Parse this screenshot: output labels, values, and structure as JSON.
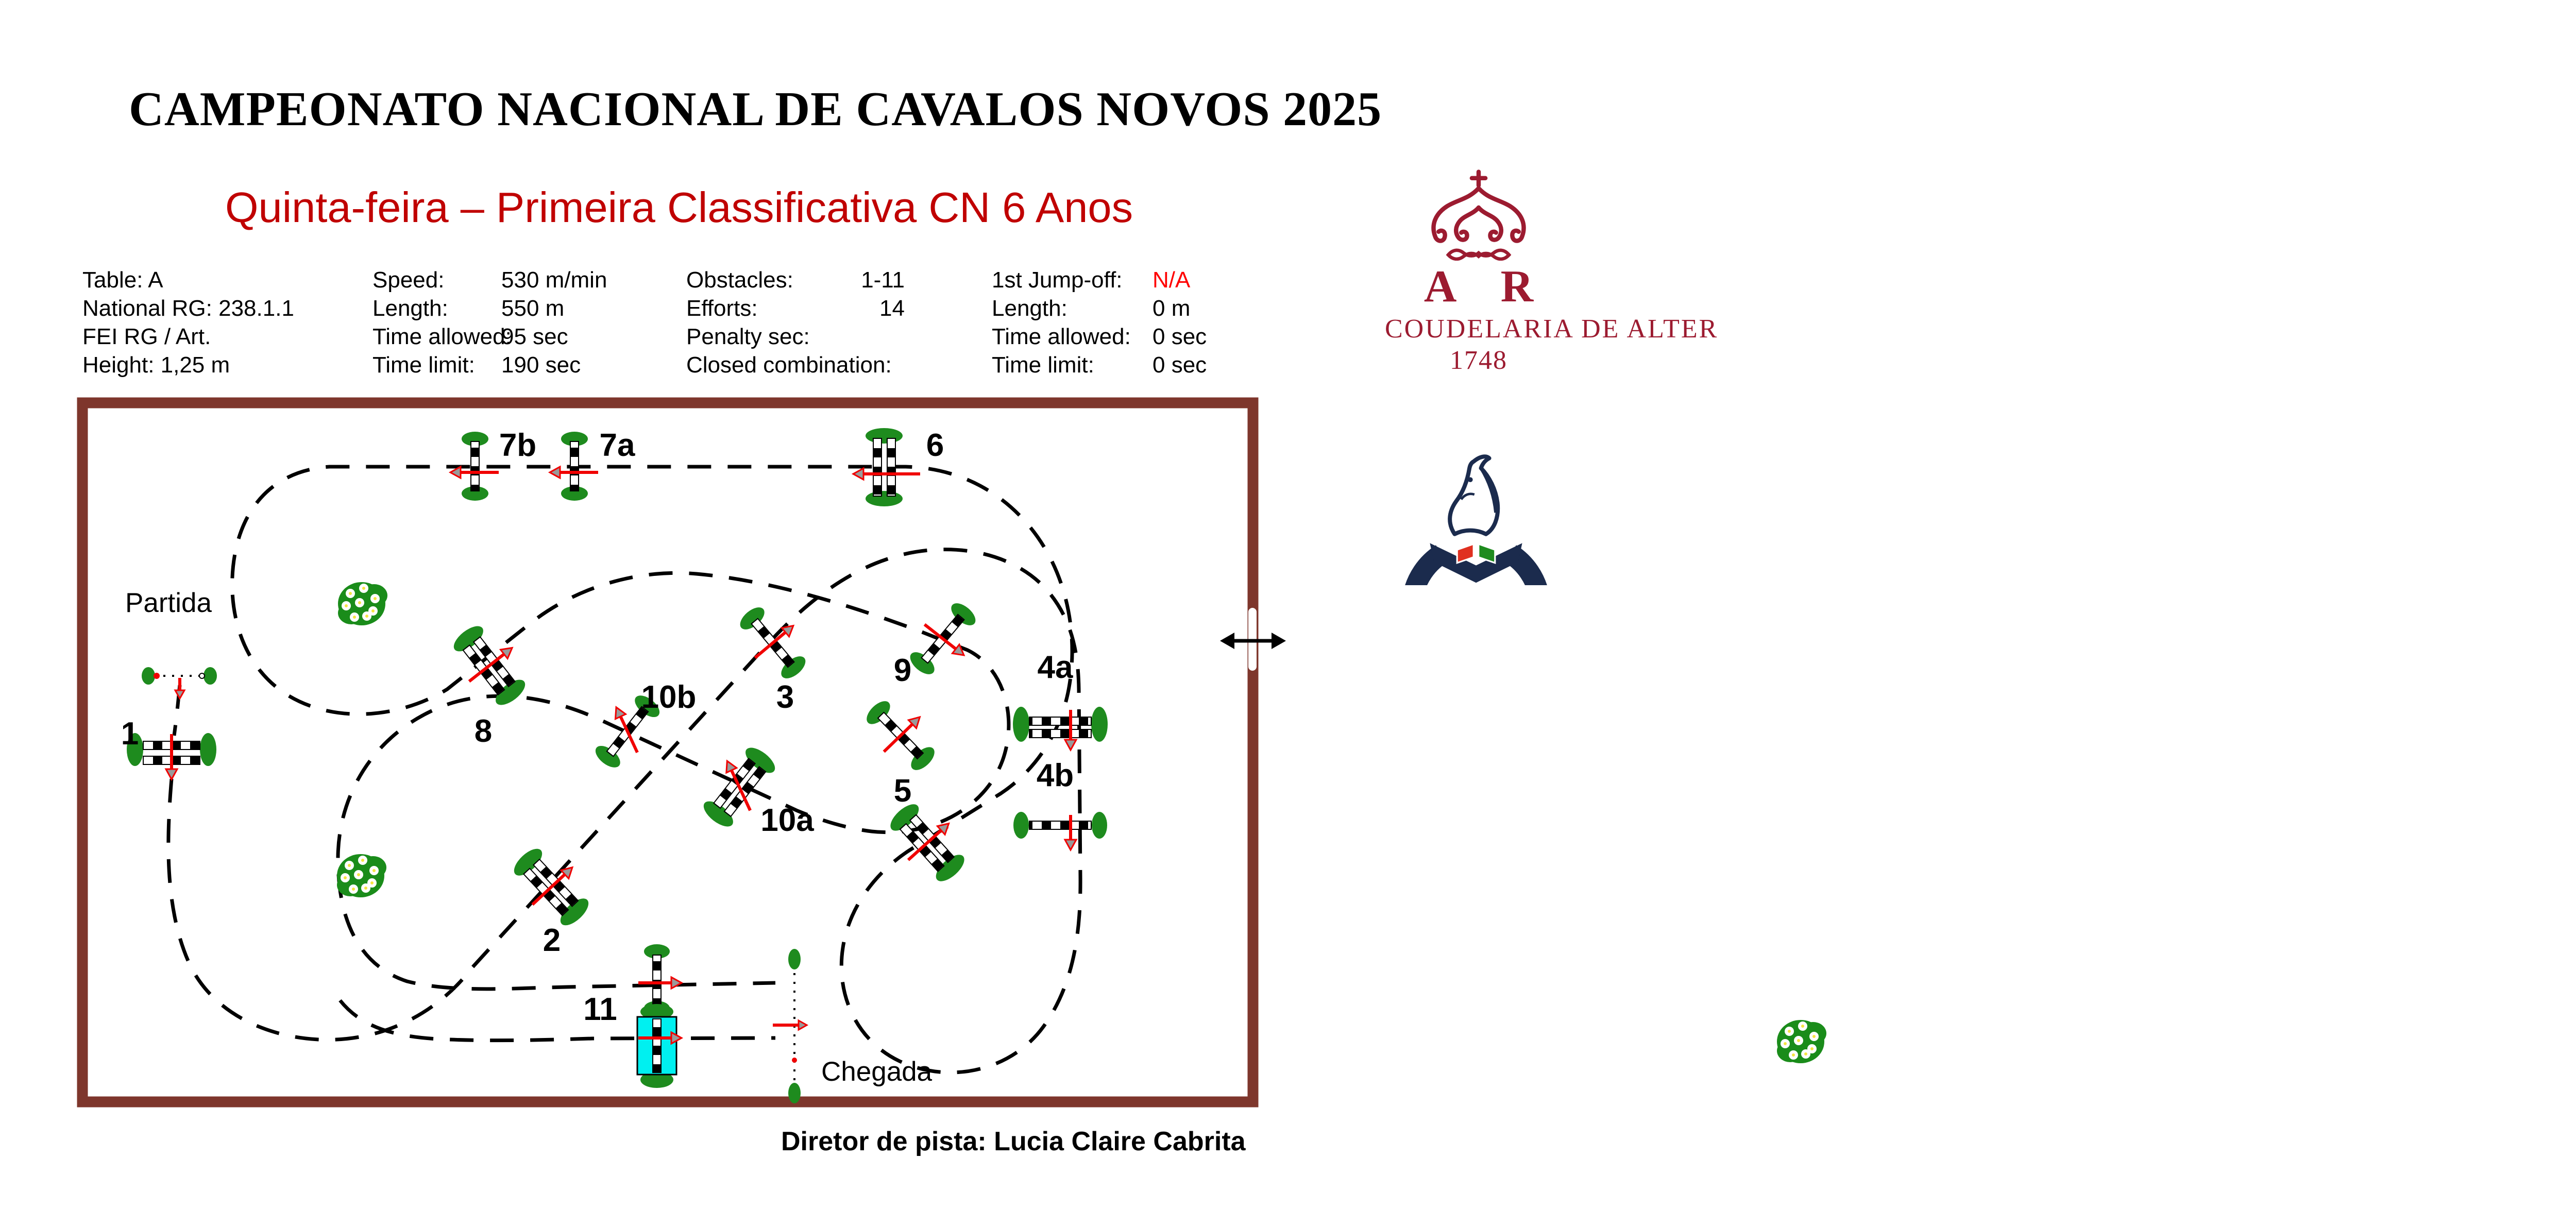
{
  "header": {
    "title": "CAMPEONATO NACIONAL DE CAVALOS NOVOS 2025",
    "subtitle": "Quinta-feira – Primeira Classificativa CN 6 Anos"
  },
  "info": {
    "col1": [
      "Table: A",
      "National RG: 238.1.1",
      "FEI RG / Art.",
      "Height: 1,25 m"
    ],
    "col2": [
      {
        "label": "Speed:",
        "value": "530 m/min"
      },
      {
        "label": "Length:",
        "value": "550 m"
      },
      {
        "label": "Time allowed:",
        "value": "95 sec"
      },
      {
        "label": "Time limit:",
        "value": "190 sec"
      }
    ],
    "col3": [
      {
        "label": "Obstacles:",
        "value": "1-11"
      },
      {
        "label": "Efforts:",
        "value": "14"
      },
      {
        "label": "Penalty sec:",
        "value": ""
      },
      {
        "label": "Closed combination:",
        "value": ""
      }
    ],
    "col4": [
      {
        "label": "1st Jump-off:",
        "value": "N/A"
      },
      {
        "label": "Length:",
        "value": "0 m"
      },
      {
        "label": "Time allowed:",
        "value": "0 sec"
      },
      {
        "label": "Time limit:",
        "value": "0 sec"
      }
    ]
  },
  "logos": {
    "ar": {
      "monogram": "A R",
      "name": "COUDELARIA DE ALTER",
      "year": "1748"
    },
    "fep": {
      "arc_text": "FEDERAÇÃO EQUESTRE PORTUGUESA"
    }
  },
  "course": {
    "start": "Partida",
    "finish": "Chegada",
    "director": "Diretor de pista: Lucia Claire Cabrita",
    "obstacles": [
      {
        "label": "1"
      },
      {
        "label": "2"
      },
      {
        "label": "3"
      },
      {
        "label": "4a"
      },
      {
        "label": "4b"
      },
      {
        "label": "5"
      },
      {
        "label": "6"
      },
      {
        "label": "7a"
      },
      {
        "label": "7b"
      },
      {
        "label": "8"
      },
      {
        "label": "9"
      },
      {
        "label": "10a"
      },
      {
        "label": "10b"
      },
      {
        "label": "11"
      }
    ]
  },
  "colors": {
    "wall_maroon": "#7E362C",
    "arrow_red": "#F00000",
    "subtitle_red": "#C00000",
    "ar_red": "#9C1B30",
    "bush_green": "#1E8B1E",
    "fep_navy": "#1B2B4D",
    "water_cyan": "#00F0F0"
  }
}
